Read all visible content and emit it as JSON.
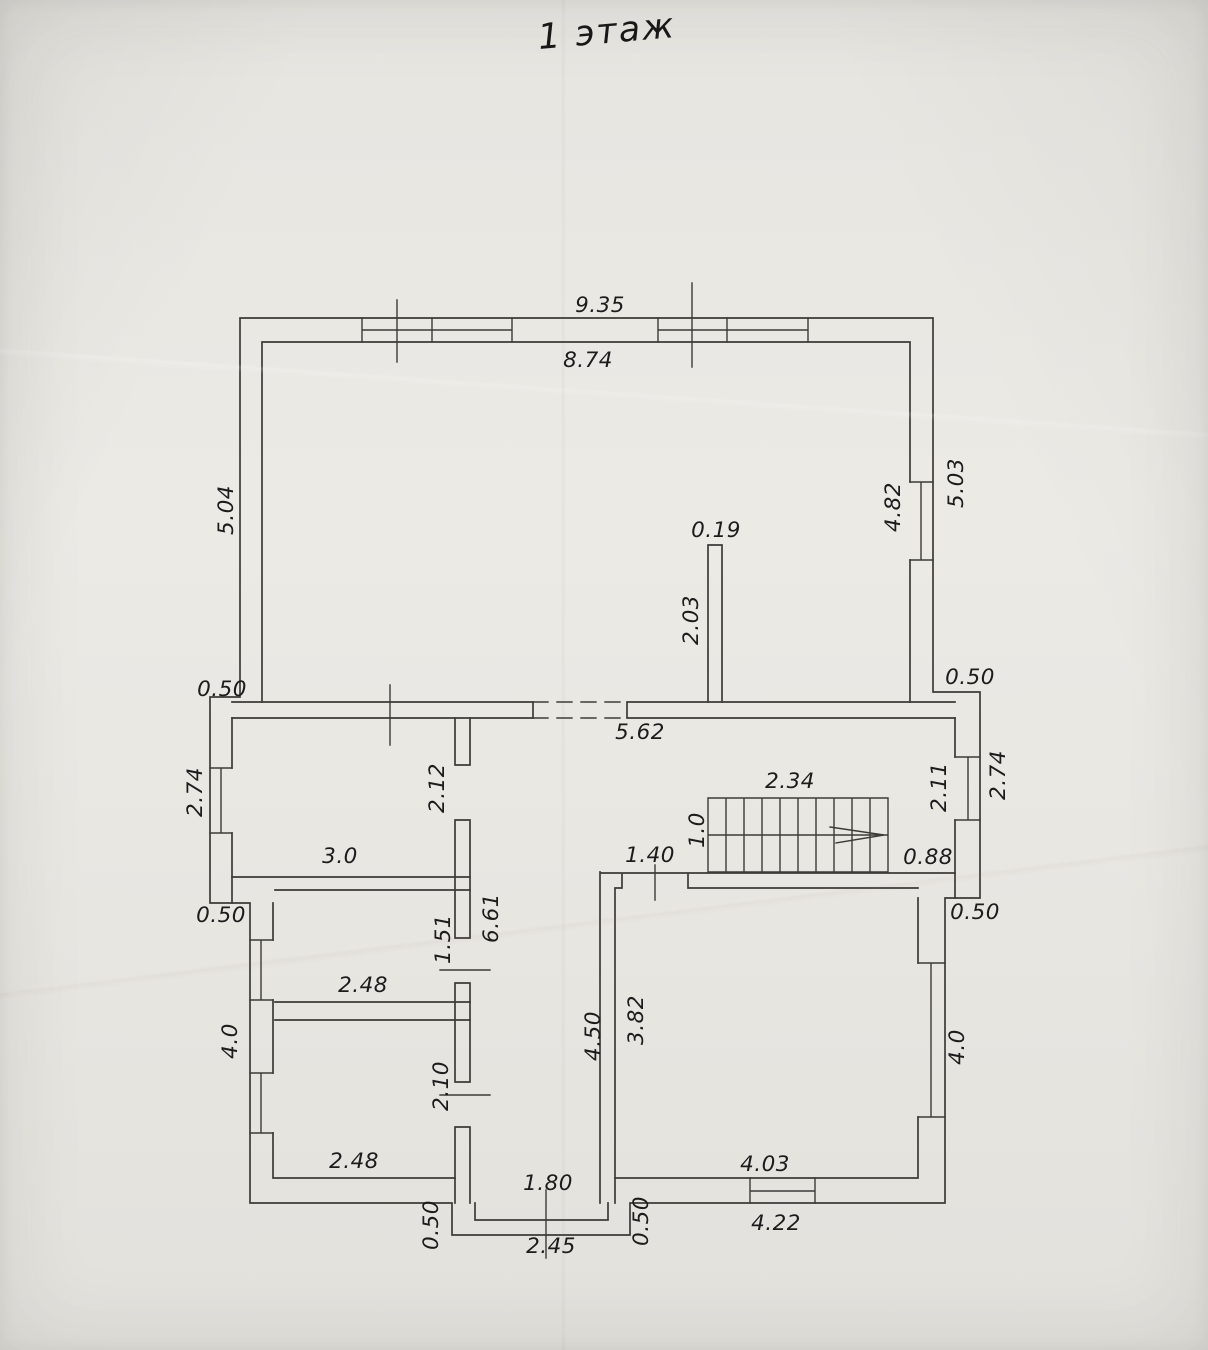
{
  "title": "1 этаж",
  "colors": {
    "paper": "#e9e7e2",
    "line": "#3d3b38",
    "text": "#1c1c1c"
  },
  "floor_plan": {
    "dimension_labels": [
      {
        "text": "9.35",
        "x": 600,
        "y": 306,
        "rotated": false
      },
      {
        "text": "8.74",
        "x": 588,
        "y": 361,
        "rotated": false
      },
      {
        "text": "5.04",
        "x": 227,
        "y": 510,
        "rotated": true
      },
      {
        "text": "0.50",
        "x": 222,
        "y": 690,
        "rotated": false
      },
      {
        "text": "2.74",
        "x": 196,
        "y": 792,
        "rotated": true
      },
      {
        "text": "0.50",
        "x": 221,
        "y": 916,
        "rotated": false
      },
      {
        "text": "4.0",
        "x": 231,
        "y": 1041,
        "rotated": true
      },
      {
        "text": "5.03",
        "x": 957,
        "y": 483,
        "rotated": true
      },
      {
        "text": "4.82",
        "x": 894,
        "y": 507,
        "rotated": true
      },
      {
        "text": "0.50",
        "x": 970,
        "y": 678,
        "rotated": false
      },
      {
        "text": "2.74",
        "x": 999,
        "y": 775,
        "rotated": true
      },
      {
        "text": "2.11",
        "x": 940,
        "y": 787,
        "rotated": true
      },
      {
        "text": "0.88",
        "x": 928,
        "y": 858,
        "rotated": false
      },
      {
        "text": "0.50",
        "x": 975,
        "y": 913,
        "rotated": false
      },
      {
        "text": "4.0",
        "x": 958,
        "y": 1047,
        "rotated": true
      },
      {
        "text": "0.19",
        "x": 716,
        "y": 531,
        "rotated": false
      },
      {
        "text": "2.03",
        "x": 692,
        "y": 620,
        "rotated": true
      },
      {
        "text": "5.62",
        "x": 640,
        "y": 733,
        "rotated": false
      },
      {
        "text": "2.34",
        "x": 790,
        "y": 782,
        "rotated": false
      },
      {
        "text": "1.0",
        "x": 698,
        "y": 830,
        "rotated": true
      },
      {
        "text": "1.40",
        "x": 650,
        "y": 856,
        "rotated": false
      },
      {
        "text": "2.12",
        "x": 438,
        "y": 788,
        "rotated": true
      },
      {
        "text": "3.0",
        "x": 340,
        "y": 857,
        "rotated": false
      },
      {
        "text": "6.61",
        "x": 492,
        "y": 918,
        "rotated": true
      },
      {
        "text": "1.51",
        "x": 444,
        "y": 939,
        "rotated": true
      },
      {
        "text": "2.48",
        "x": 363,
        "y": 986,
        "rotated": false
      },
      {
        "text": "2.10",
        "x": 442,
        "y": 1086,
        "rotated": true
      },
      {
        "text": "2.48",
        "x": 354,
        "y": 1162,
        "rotated": false
      },
      {
        "text": "4.50",
        "x": 594,
        "y": 1036,
        "rotated": true
      },
      {
        "text": "3.82",
        "x": 637,
        "y": 1020,
        "rotated": true
      },
      {
        "text": "1.80",
        "x": 548,
        "y": 1184,
        "rotated": false
      },
      {
        "text": "4.03",
        "x": 765,
        "y": 1165,
        "rotated": false
      },
      {
        "text": "0.50",
        "x": 432,
        "y": 1225,
        "rotated": true
      },
      {
        "text": "2.45",
        "x": 551,
        "y": 1247,
        "rotated": false
      },
      {
        "text": "0.50",
        "x": 642,
        "y": 1221,
        "rotated": true
      },
      {
        "text": "4.22",
        "x": 776,
        "y": 1224,
        "rotated": false
      }
    ]
  }
}
